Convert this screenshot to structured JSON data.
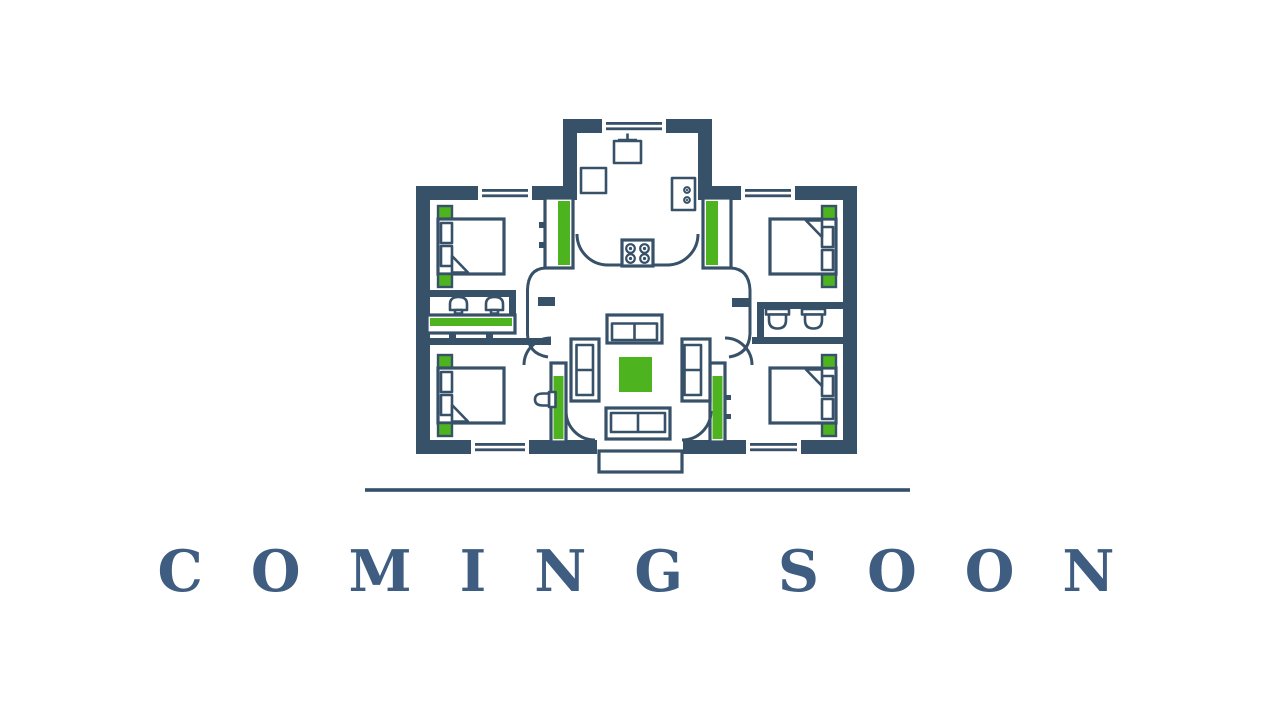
{
  "theme": {
    "bg": "#ffffff",
    "wall": "#375169",
    "green": "#4db31e",
    "text": "#3f5d80",
    "line": "#33506c"
  },
  "hero": {
    "heading": "COMING SOON"
  },
  "floorplan": {
    "name": "house-floor-plan",
    "rooms": [
      "kitchen",
      "living-room",
      "bedroom-top-left",
      "bedroom-top-right",
      "bedroom-bottom-left",
      "bedroom-bottom-right",
      "bathroom-left",
      "bathroom-right",
      "entrance-porch"
    ]
  }
}
